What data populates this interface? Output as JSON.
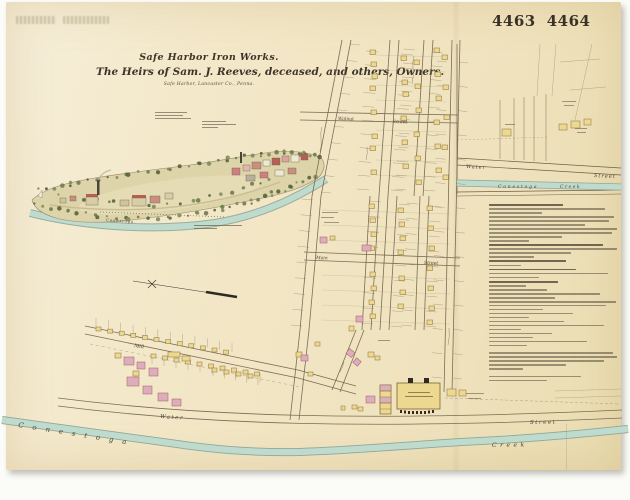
{
  "plate": {
    "left": "4463",
    "right": "4464"
  },
  "title": {
    "line1": "Safe Harbor Iron Works.",
    "line2": "The Heirs of Sam. J. Reeves, deceased, and others, Owners.",
    "line3": "Safe Harbor, Lancaster Co., Penna."
  },
  "map_labels": {
    "walnut": "Walnut",
    "walnut_street": "Street",
    "main": "Main",
    "main_street": "Street",
    "mill": "Mill",
    "water": "Water",
    "water_street": "Street",
    "conestoga": "Conestoga",
    "creek": "Creek",
    "inset_water": "Water",
    "inset_street": "Street",
    "inset_conestoga": "Conestoga",
    "inset_creek": "Creek",
    "illus_conestoga": "Conestoga"
  },
  "colors": {
    "paper": "#f2e7c8",
    "ink": "#4a4234",
    "water": "#bfdbce",
    "building_frame": "#ecd98f",
    "building_brick": "#dcaebb",
    "roof_red": "#b85f55"
  },
  "credits": {
    "left": [
      32,
      28,
      36
    ],
    "right": [
      24,
      34,
      16
    ]
  },
  "caption_widths": [
    46,
    22
  ],
  "reference": {
    "lines": [
      {
        "w": 56,
        "d": 1
      },
      {
        "w": 88
      },
      {
        "w": 40
      },
      {
        "w": 95
      },
      {
        "w": 91
      },
      {
        "w": 73
      },
      {
        "w": 97
      },
      {
        "w": 93
      },
      {
        "w": 55
      },
      {
        "w": 30
      },
      {
        "w": 86,
        "d": 1
      },
      {
        "w": 97
      },
      {
        "w": 62
      },
      {
        "w": 34
      },
      {
        "w": 58,
        "d": 1
      },
      {
        "w": 24
      },
      {
        "w": 66,
        "d": 1
      },
      {
        "w": 90
      },
      {
        "w": 38
      },
      {
        "w": 52,
        "d": 1
      },
      {
        "w": 28
      },
      {
        "w": 44
      },
      {
        "w": 84
      },
      {
        "w": 50
      },
      {
        "w": 96
      },
      {
        "w": 89
      },
      {
        "w": 41
      },
      {
        "w": 64
      },
      {
        "w": 30
      },
      {
        "w": 57
      },
      {
        "w": 87
      },
      {
        "w": 24
      },
      {
        "w": 48
      },
      {
        "w": 33
      },
      {
        "w": 74
      },
      {
        "w": 29
      },
      {
        "w": 94,
        "g": 1
      },
      {
        "w": 97
      },
      {
        "w": 87
      },
      {
        "w": 58
      },
      {
        "w": 26
      },
      {
        "w": 70,
        "g": 1
      },
      {
        "w": 44
      }
    ]
  }
}
